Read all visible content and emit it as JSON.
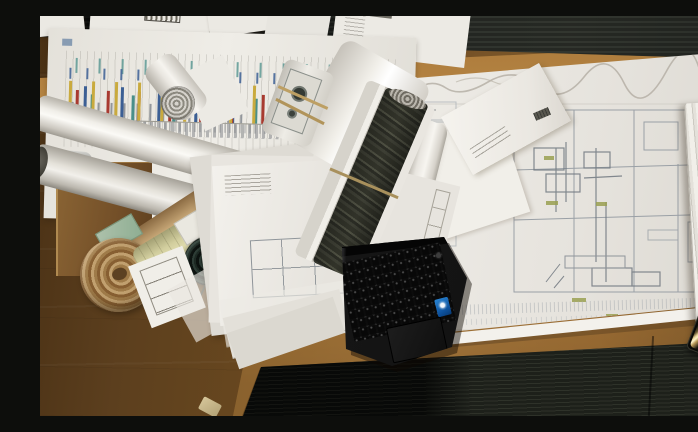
{
  "scene": {
    "type": "photograph",
    "description": "Top-down photograph of a wooden desk covered with architectural floor plans, rolled-up blueprint tubes, stacks of drawings, a printed bar-chart schedule, an open black laptop with a blue Intel sticker, and a smartphone, with dark carpet tiles visible along the top and bottom edges",
    "objects": [
      "wooden desk surface",
      "dark carpet tiles",
      "large architectural floor plan sheet",
      "printed bar chart schedule sheet",
      "rolled blueprint tubes",
      "kraft paper roll with spiral end",
      "olive-green rolled drawing",
      "dark rolled drawing with cord",
      "stack of drawing sheets",
      "open black laptop",
      "laptop keyboard",
      "laptop touchpad",
      "intel sticker",
      "white envelope",
      "white paper tube",
      "stacked paper edge pile",
      "smartphone with light reflection",
      "hanging printed papers",
      "cardboard box edge",
      "small paper scrap"
    ],
    "colors": {
      "desk_wood": "#6b4a24",
      "desk_edge_highlight": "#b5823c",
      "carpet_dark": "#17181a",
      "paper_white": "#edebe5",
      "kraft_roll_tan": "#b8935e",
      "olive_roll": "#d4d0a0",
      "dark_roll_teal": "#1d2923",
      "laptop_body": "#161616",
      "intel_sticker_blue": "#1a6fc4",
      "phone_reflection_gold": "#e8d49a",
      "chart_bar_yellow": "#c9aa3e",
      "chart_bar_red": "#a83a30",
      "chart_bar_blue": "#3c5f94",
      "chart_bar_teal": "#4a8f8a",
      "plan_linework_gray": "#9aa0a6",
      "plan_highlight_olive": "#9aa052"
    }
  }
}
